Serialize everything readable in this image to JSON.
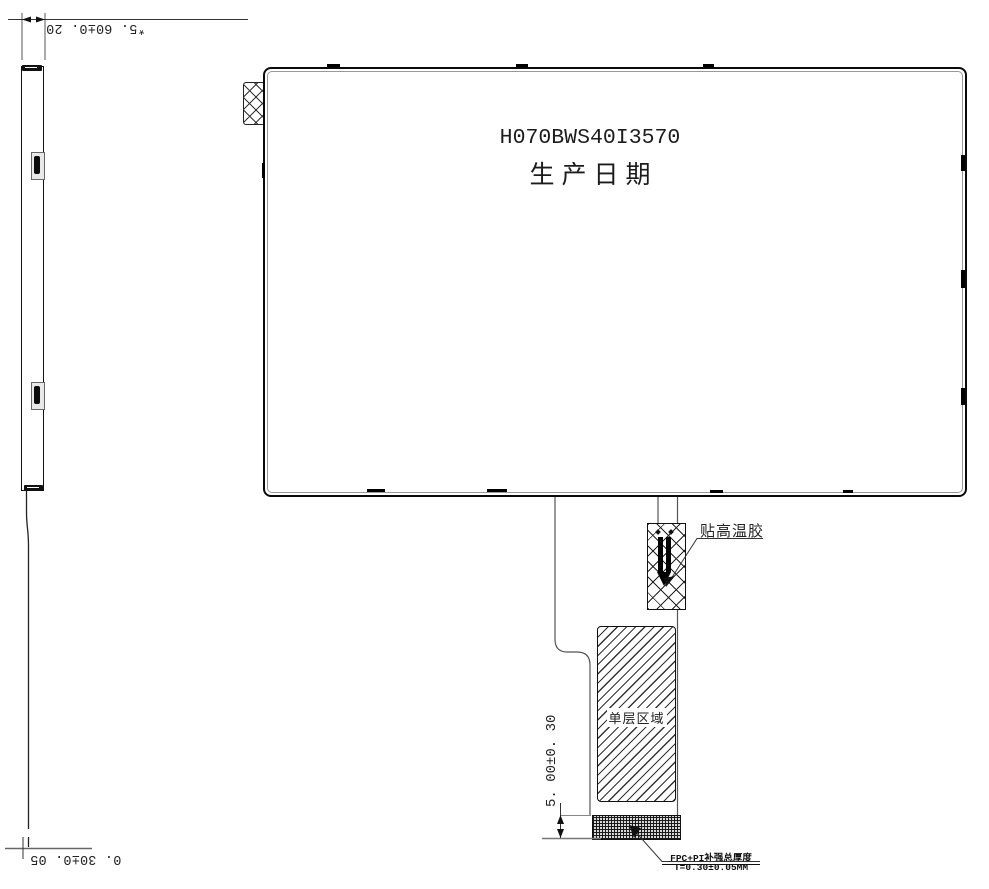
{
  "panel": {
    "part_number": "H070BWS40I3570",
    "production_date_label": "生产日期"
  },
  "side_view": {
    "thickness_dim_top": "*5. 60±0. 20",
    "thickness_dim_bottom": "0. 30±0. 05"
  },
  "fpc": {
    "tape_label": "贴高温胶",
    "single_layer_label": "单层区域",
    "stiffener_height_dim": "5. 00±0. 30",
    "stiffener_note_title": "FPC+PI补强总厚度",
    "stiffener_note_value": "T=0.30±0.05MM"
  },
  "colors": {
    "line": "#1a1a1a",
    "background": "#ffffff"
  }
}
